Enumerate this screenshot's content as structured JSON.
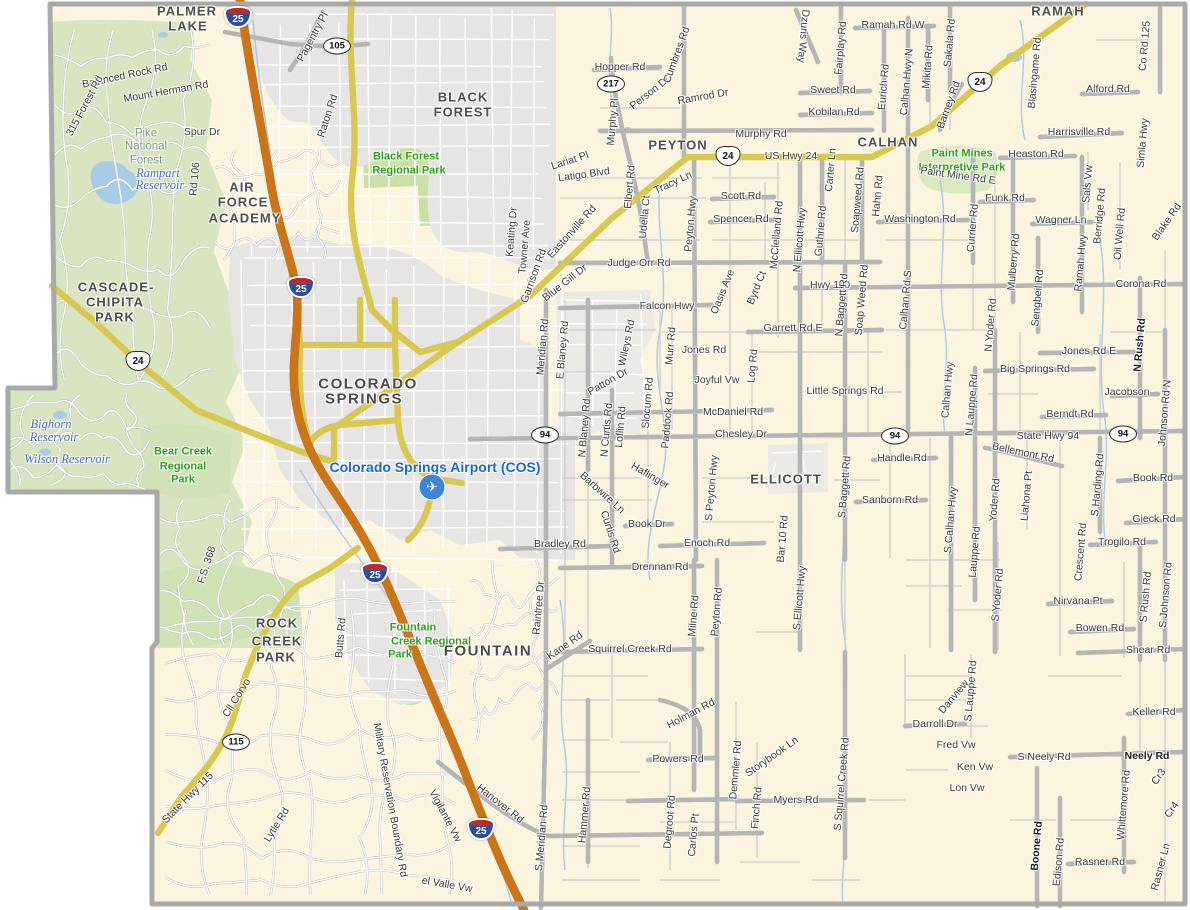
{
  "map_title": "El Paso County area road map",
  "colors": {
    "land": "#FBF4DF",
    "forest": "#D8E5C0",
    "park": "#CBE0A4",
    "urban": "#E6E5E3",
    "water": "#A6CCE8",
    "interstate": "#F19B51",
    "interstate_casing": "#C97518",
    "highway_yellow": "#FBF2A0",
    "highway_yellow_casing": "#D8C750",
    "road_white": "#FFFFFF",
    "road_casing": "#B9B9B9",
    "boundary": "#A9A9A9",
    "city_text": "#4f4f4f",
    "park_text": "#2f9e1e",
    "water_text": "#4a6fc0",
    "airport_text": "#1a66cc",
    "road_text": "#3d3d3d"
  },
  "airport": {
    "icon": "✈",
    "x": 432,
    "y": 487
  },
  "shields": [
    {
      "type": "interstate",
      "num": "25",
      "x": 238,
      "y": 17
    },
    {
      "type": "interstate",
      "num": "25",
      "x": 301,
      "y": 287
    },
    {
      "type": "interstate",
      "num": "25",
      "x": 375,
      "y": 573
    },
    {
      "type": "interstate",
      "num": "25",
      "x": 481,
      "y": 829
    },
    {
      "type": "us",
      "num": "24",
      "x": 138,
      "y": 361
    },
    {
      "type": "us",
      "num": "24",
      "x": 728,
      "y": 156
    },
    {
      "type": "us",
      "num": "24",
      "x": 980,
      "y": 82
    },
    {
      "type": "state",
      "num": "105",
      "x": 337,
      "y": 46
    },
    {
      "type": "state",
      "num": "217",
      "x": 611,
      "y": 84
    },
    {
      "type": "state",
      "num": "115",
      "x": 236,
      "y": 742
    },
    {
      "type": "state",
      "num": "94",
      "x": 545,
      "y": 435
    },
    {
      "type": "state",
      "num": "94",
      "x": 895,
      "y": 436
    },
    {
      "type": "state",
      "num": "94",
      "x": 1123,
      "y": 434
    }
  ],
  "labels": [
    {
      "t": "PALMER",
      "x": 187,
      "y": 11,
      "c": "ct"
    },
    {
      "t": "LAKE",
      "x": 188,
      "y": 26,
      "c": "ct"
    },
    {
      "t": "BLACK",
      "x": 463,
      "y": 97,
      "c": "ct"
    },
    {
      "t": "FOREST",
      "x": 463,
      "y": 112,
      "c": "ct"
    },
    {
      "t": "AIR",
      "x": 242,
      "y": 187,
      "c": "ct"
    },
    {
      "t": "FORCE",
      "x": 243,
      "y": 202,
      "c": "ct"
    },
    {
      "t": "ACADEMY",
      "x": 245,
      "y": 218,
      "c": "ct"
    },
    {
      "t": "CASCADE-",
      "x": 116,
      "y": 287,
      "c": "ct"
    },
    {
      "t": "CHIPITA",
      "x": 115,
      "y": 302,
      "c": "ct"
    },
    {
      "t": "PARK",
      "x": 115,
      "y": 317,
      "c": "ct"
    },
    {
      "t": "COLORADO",
      "x": 368,
      "y": 384,
      "c": "ctl"
    },
    {
      "t": "SPRINGS",
      "x": 364,
      "y": 399,
      "c": "ctl"
    },
    {
      "t": "PEYTON",
      "x": 678,
      "y": 145,
      "c": "ct"
    },
    {
      "t": "CALHAN",
      "x": 888,
      "y": 142,
      "c": "ct"
    },
    {
      "t": "RAMAH",
      "x": 1058,
      "y": 11,
      "c": "ct"
    },
    {
      "t": "ELLICOTT",
      "x": 786,
      "y": 479,
      "c": "ct"
    },
    {
      "t": "FOUNTAIN",
      "x": 488,
      "y": 651,
      "c": "ctl"
    },
    {
      "t": "ROCK",
      "x": 277,
      "y": 623,
      "c": "ct"
    },
    {
      "t": "CREEK",
      "x": 277,
      "y": 641,
      "c": "ct"
    },
    {
      "t": "PARK",
      "x": 276,
      "y": 657,
      "c": "ct"
    },
    {
      "t": "Pike",
      "x": 146,
      "y": 134,
      "c": "fo"
    },
    {
      "t": "National",
      "x": 146,
      "y": 147,
      "c": "fo"
    },
    {
      "t": "Forest",
      "x": 146,
      "y": 161,
      "c": "fo"
    },
    {
      "t": "Rampart",
      "x": 158,
      "y": 173,
      "c": "wt"
    },
    {
      "t": "Reservoir",
      "x": 160,
      "y": 185,
      "c": "wt"
    },
    {
      "t": "Bighorn",
      "x": 51,
      "y": 424,
      "c": "wt"
    },
    {
      "t": "Reservoir",
      "x": 54,
      "y": 437,
      "c": "wt"
    },
    {
      "t": "Wilson Reservoir",
      "x": 67,
      "y": 459,
      "c": "wt"
    },
    {
      "t": "Black Forest",
      "x": 406,
      "y": 157,
      "c": "pk"
    },
    {
      "t": "Regional Park",
      "x": 409,
      "y": 171,
      "c": "pk"
    },
    {
      "t": "Bear Creek",
      "x": 183,
      "y": 452,
      "c": "pk"
    },
    {
      "t": "Regional",
      "x": 183,
      "y": 467,
      "c": "pk"
    },
    {
      "t": "Park",
      "x": 183,
      "y": 480,
      "c": "pk"
    },
    {
      "t": "Fountain",
      "x": 413,
      "y": 628,
      "c": "pk"
    },
    {
      "t": "Creek Regional",
      "x": 431,
      "y": 642,
      "c": "pk"
    },
    {
      "t": "Park",
      "x": 400,
      "y": 655,
      "c": "pk"
    },
    {
      "t": "Paint Mines",
      "x": 962,
      "y": 154,
      "c": "pk"
    },
    {
      "t": "Interpretive Park",
      "x": 962,
      "y": 168,
      "c": "pk"
    },
    {
      "t": "Colorado Springs Airport (COS)",
      "x": 435,
      "y": 467,
      "c": "ap"
    },
    {
      "t": "Pagentry Pl",
      "x": 313,
      "y": 37,
      "r": -62
    },
    {
      "t": "Balanced Rock Rd",
      "x": 125,
      "y": 76,
      "r": -12
    },
    {
      "t": "Mount Herman Rd",
      "x": 166,
      "y": 92,
      "r": -10
    },
    {
      "t": "315 Forest Rd",
      "x": 85,
      "y": 106,
      "r": -62
    },
    {
      "t": "Spur Dr",
      "x": 202,
      "y": 132
    },
    {
      "t": "Rd 106",
      "x": 195,
      "y": 179,
      "r": -85
    },
    {
      "t": "Raton Rd",
      "x": 328,
      "y": 116,
      "r": -72
    },
    {
      "t": "Hopper Rd",
      "x": 620,
      "y": 67
    },
    {
      "t": "Murphy Pl",
      "x": 613,
      "y": 122,
      "r": -85
    },
    {
      "t": "Person Dr",
      "x": 650,
      "y": 93,
      "r": -38
    },
    {
      "t": "Cumbres Rd",
      "x": 677,
      "y": 55,
      "r": -70
    },
    {
      "t": "Ramrod Dr",
      "x": 703,
      "y": 97,
      "r": -10
    },
    {
      "t": "Murphy Rd",
      "x": 761,
      "y": 134
    },
    {
      "t": "Dzuris Way",
      "x": 803,
      "y": 36,
      "r": 95
    },
    {
      "t": "Fairplay Rd",
      "x": 841,
      "y": 48,
      "r": -85
    },
    {
      "t": "Ramah Rd W",
      "x": 893,
      "y": 25
    },
    {
      "t": "Sweet Rd",
      "x": 833,
      "y": 90
    },
    {
      "t": "Kobilan Rd",
      "x": 834,
      "y": 112
    },
    {
      "t": "Eurich Rd",
      "x": 884,
      "y": 87,
      "r": -85
    },
    {
      "t": "Calhan Hwy N",
      "x": 907,
      "y": 82,
      "r": -85
    },
    {
      "t": "Mikita Rd",
      "x": 928,
      "y": 67,
      "r": -85
    },
    {
      "t": "Sakala Rd",
      "x": 950,
      "y": 43,
      "r": -85
    },
    {
      "t": "Barney Rd",
      "x": 949,
      "y": 105,
      "r": -70
    },
    {
      "t": "Blasingame Rd",
      "x": 1035,
      "y": 73,
      "r": -85
    },
    {
      "t": "Co Rd 125",
      "x": 1145,
      "y": 46,
      "r": -85
    },
    {
      "t": "Alford Rd",
      "x": 1108,
      "y": 89
    },
    {
      "t": "Harrisville Rd",
      "x": 1079,
      "y": 132
    },
    {
      "t": "Simla Hwy",
      "x": 1143,
      "y": 143,
      "r": -85
    },
    {
      "t": "Heaston Rd",
      "x": 1036,
      "y": 154
    },
    {
      "t": "Paint Mine Rd E",
      "x": 958,
      "y": 176,
      "r": 8
    },
    {
      "t": "Funk Rd",
      "x": 1005,
      "y": 198
    },
    {
      "t": "Wagner Ln",
      "x": 1061,
      "y": 220
    },
    {
      "t": "Sals Vw",
      "x": 1088,
      "y": 184,
      "r": -85
    },
    {
      "t": "Berridge Rd",
      "x": 1100,
      "y": 216,
      "r": -85
    },
    {
      "t": "Oil Well Rd",
      "x": 1120,
      "y": 234,
      "r": -85
    },
    {
      "t": "Blake Rd",
      "x": 1167,
      "y": 222,
      "r": -55
    },
    {
      "t": "Carter Ln",
      "x": 831,
      "y": 170,
      "r": -85
    },
    {
      "t": "Soapweed Rd",
      "x": 858,
      "y": 200,
      "r": -85
    },
    {
      "t": "Hahn Rd",
      "x": 878,
      "y": 196,
      "r": -85
    },
    {
      "t": "Washington Rd",
      "x": 920,
      "y": 219
    },
    {
      "t": "Currier Rd",
      "x": 973,
      "y": 228,
      "r": -85
    },
    {
      "t": "Mulberry Rd",
      "x": 1014,
      "y": 262,
      "r": -85
    },
    {
      "t": "Sengbeil Rd",
      "x": 1038,
      "y": 298,
      "r": -85
    },
    {
      "t": "Ramah Hwy",
      "x": 1081,
      "y": 263,
      "r": -85
    },
    {
      "t": "Corona Rd",
      "x": 1141,
      "y": 284
    },
    {
      "t": "US Hwy 24",
      "x": 791,
      "y": 156
    },
    {
      "t": "Scott Rd",
      "x": 741,
      "y": 196
    },
    {
      "t": "Spencer Rd",
      "x": 741,
      "y": 219
    },
    {
      "t": "McClelland Rd",
      "x": 777,
      "y": 235,
      "r": -85
    },
    {
      "t": "Guthrie Rd",
      "x": 821,
      "y": 231,
      "r": -85
    },
    {
      "t": "N Ellicott Hwy",
      "x": 800,
      "y": 240,
      "r": -85
    },
    {
      "t": "Peyton Hwy",
      "x": 691,
      "y": 224,
      "r": -85
    },
    {
      "t": "Tracy Ln",
      "x": 673,
      "y": 183,
      "r": -25
    },
    {
      "t": "Udella Ct",
      "x": 645,
      "y": 217,
      "r": -85
    },
    {
      "t": "Elbert Rd",
      "x": 630,
      "y": 187,
      "r": -85
    },
    {
      "t": "Lariat Pl",
      "x": 570,
      "y": 161,
      "r": -18
    },
    {
      "t": "Latigo Blvd",
      "x": 584,
      "y": 175,
      "r": -8
    },
    {
      "t": "Keating Dr",
      "x": 512,
      "y": 232,
      "r": -85
    },
    {
      "t": "Towner Ave",
      "x": 525,
      "y": 247,
      "r": -85
    },
    {
      "t": "Garrison Rd",
      "x": 534,
      "y": 276,
      "r": -70
    },
    {
      "t": "Eastonville Rd",
      "x": 572,
      "y": 232,
      "r": -48
    },
    {
      "t": "Blue Gill Dr",
      "x": 565,
      "y": 283,
      "r": -38
    },
    {
      "t": "Judge Orr Rd",
      "x": 639,
      "y": 263
    },
    {
      "t": "Hwy 110",
      "x": 830,
      "y": 285
    },
    {
      "t": "Falcon Hwy",
      "x": 667,
      "y": 306
    },
    {
      "t": "Oasis Ave",
      "x": 723,
      "y": 292,
      "r": -68
    },
    {
      "t": "Byrd Ct",
      "x": 757,
      "y": 288,
      "r": -68
    },
    {
      "t": "Garrett Rd E",
      "x": 793,
      "y": 328
    },
    {
      "t": "Log Rd",
      "x": 753,
      "y": 366,
      "r": -85
    },
    {
      "t": "Jones Rd",
      "x": 704,
      "y": 350
    },
    {
      "t": "Joyful Vw",
      "x": 717,
      "y": 380
    },
    {
      "t": "Murr Rd",
      "x": 671,
      "y": 346,
      "r": -85
    },
    {
      "t": "Wileys Rd",
      "x": 627,
      "y": 343,
      "r": -78
    },
    {
      "t": "Patton Dr",
      "x": 608,
      "y": 382,
      "r": -30
    },
    {
      "t": "Slocum Rd",
      "x": 648,
      "y": 403,
      "r": -85
    },
    {
      "t": "Paddock Rd",
      "x": 668,
      "y": 420,
      "r": -85
    },
    {
      "t": "Meridian Rd",
      "x": 543,
      "y": 347,
      "r": -85
    },
    {
      "t": "E Blaney Rd",
      "x": 563,
      "y": 350,
      "r": -85
    },
    {
      "t": "N Blaney Rd",
      "x": 585,
      "y": 428,
      "r": -85
    },
    {
      "t": "N Curtis Rd",
      "x": 607,
      "y": 430,
      "r": -85
    },
    {
      "t": "Loflin Rd",
      "x": 621,
      "y": 427,
      "r": -85
    },
    {
      "t": "N Baggett Rd",
      "x": 842,
      "y": 305,
      "r": -85
    },
    {
      "t": "Soap Weed Rd",
      "x": 862,
      "y": 300,
      "r": -85
    },
    {
      "t": "Calhan Rd S",
      "x": 906,
      "y": 300,
      "r": -85
    },
    {
      "t": "Little Springs Rd",
      "x": 845,
      "y": 391
    },
    {
      "t": "Big Springs Rd",
      "x": 1035,
      "y": 369
    },
    {
      "t": "Jones Rd E",
      "x": 1089,
      "y": 351
    },
    {
      "t": "N Yoder Rd",
      "x": 991,
      "y": 325,
      "r": -85
    },
    {
      "t": "N Lauppe Rd",
      "x": 972,
      "y": 405,
      "r": -85
    },
    {
      "t": "Calhan Hwy",
      "x": 948,
      "y": 390,
      "r": -85
    },
    {
      "t": "Jacobson",
      "x": 1127,
      "y": 392
    },
    {
      "t": "Berndt Rd",
      "x": 1070,
      "y": 414
    },
    {
      "t": "N Rush Rd",
      "x": 1140,
      "y": 345,
      "r": -85,
      "c": "rdb"
    },
    {
      "t": "Johnson Rd N",
      "x": 1165,
      "y": 413,
      "r": -85
    },
    {
      "t": "State Hwy 94",
      "x": 1048,
      "y": 436
    },
    {
      "t": "McDaniel Rd",
      "x": 733,
      "y": 412
    },
    {
      "t": "Chesley Dr",
      "x": 741,
      "y": 434
    },
    {
      "t": "Handle Rd",
      "x": 902,
      "y": 458
    },
    {
      "t": "Bellemont Rd",
      "x": 1023,
      "y": 453,
      "r": 12
    },
    {
      "t": "Sanborn Rd",
      "x": 890,
      "y": 500
    },
    {
      "t": "Book Rd",
      "x": 1153,
      "y": 478
    },
    {
      "t": "Gieck Rd",
      "x": 1154,
      "y": 519
    },
    {
      "t": "Trogilo Rd",
      "x": 1122,
      "y": 542
    },
    {
      "t": "Liahona Pt",
      "x": 1027,
      "y": 496,
      "r": -85
    },
    {
      "t": "S Harding Rd",
      "x": 1098,
      "y": 485,
      "r": -85
    },
    {
      "t": "Crescent Rd",
      "x": 1081,
      "y": 552,
      "r": -85
    },
    {
      "t": "Yoder Rd",
      "x": 995,
      "y": 500,
      "r": -85
    },
    {
      "t": "S Yoder Rd",
      "x": 998,
      "y": 595,
      "r": -85
    },
    {
      "t": "Lauppe Rd",
      "x": 975,
      "y": 552,
      "r": -85
    },
    {
      "t": "S Calhan Hwy",
      "x": 951,
      "y": 520,
      "r": -85
    },
    {
      "t": "S Baggett Rd",
      "x": 845,
      "y": 487,
      "r": -85
    },
    {
      "t": "Bar 10 Rd",
      "x": 783,
      "y": 539,
      "r": -85
    },
    {
      "t": "S Ellicott Hwy",
      "x": 800,
      "y": 598,
      "r": -85
    },
    {
      "t": "S Peyton Hwy",
      "x": 712,
      "y": 488,
      "r": -85
    },
    {
      "t": "Haflinger",
      "x": 650,
      "y": 476,
      "r": 30
    },
    {
      "t": "Barbwire Ln",
      "x": 602,
      "y": 493,
      "r": 42
    },
    {
      "t": "Curtis Rd",
      "x": 610,
      "y": 532,
      "r": 72
    },
    {
      "t": "Book Dr",
      "x": 647,
      "y": 524
    },
    {
      "t": "Bradley Rd",
      "x": 560,
      "y": 544
    },
    {
      "t": "Enoch Rd",
      "x": 707,
      "y": 543
    },
    {
      "t": "Drennan Rd",
      "x": 660,
      "y": 567
    },
    {
      "t": "Nirvana Pt",
      "x": 1078,
      "y": 601
    },
    {
      "t": "Bowen Rd",
      "x": 1100,
      "y": 628
    },
    {
      "t": "S Rush Rd",
      "x": 1146,
      "y": 597,
      "r": -85
    },
    {
      "t": "S Johnson Rd",
      "x": 1166,
      "y": 595,
      "r": -85
    },
    {
      "t": "Shear Rd",
      "x": 1148,
      "y": 650
    },
    {
      "t": "Keller Rd",
      "x": 1154,
      "y": 712
    },
    {
      "t": "Raintree Dr",
      "x": 539,
      "y": 608,
      "r": -85
    },
    {
      "t": "Kane Rd",
      "x": 565,
      "y": 646,
      "r": -35
    },
    {
      "t": "Squirrel Creek Rd",
      "x": 630,
      "y": 649
    },
    {
      "t": "Milne Rd",
      "x": 694,
      "y": 616,
      "r": -85
    },
    {
      "t": "Peyton Rd",
      "x": 717,
      "y": 612,
      "r": -85
    },
    {
      "t": "Butts Rd",
      "x": 341,
      "y": 638,
      "r": -85
    },
    {
      "t": "Cll Corvo",
      "x": 237,
      "y": 698,
      "r": -58
    },
    {
      "t": "State Hwy 115",
      "x": 188,
      "y": 798,
      "r": -45
    },
    {
      "t": "Lytle Rd",
      "x": 277,
      "y": 825,
      "r": -58
    },
    {
      "t": "F.S. 368",
      "x": 207,
      "y": 565,
      "r": -72
    },
    {
      "t": "Military Reservation Boundary Rd",
      "x": 390,
      "y": 800,
      "r": 80
    },
    {
      "t": "Vigilante Vw",
      "x": 445,
      "y": 816,
      "r": 62
    },
    {
      "t": "el Valle Vw",
      "x": 447,
      "y": 885,
      "r": 10
    },
    {
      "t": "Hanover Rd",
      "x": 500,
      "y": 804,
      "r": 38
    },
    {
      "t": "S Meridian Rd",
      "x": 542,
      "y": 838,
      "r": -85
    },
    {
      "t": "Hammer Rd",
      "x": 585,
      "y": 815,
      "r": -85
    },
    {
      "t": "Holman Rd",
      "x": 691,
      "y": 714,
      "r": -28
    },
    {
      "t": "Powers Rd",
      "x": 678,
      "y": 759
    },
    {
      "t": "Degroot Rd",
      "x": 670,
      "y": 822,
      "r": -85
    },
    {
      "t": "Carlos Pt",
      "x": 694,
      "y": 835,
      "r": -85
    },
    {
      "t": "Demmler Rd",
      "x": 736,
      "y": 770,
      "r": -85
    },
    {
      "t": "Storybook Ln",
      "x": 772,
      "y": 757,
      "r": -35
    },
    {
      "t": "Finch Rd",
      "x": 757,
      "y": 808,
      "r": -85
    },
    {
      "t": "Myers Rd",
      "x": 796,
      "y": 800
    },
    {
      "t": "S Squirrel Creek Rd",
      "x": 842,
      "y": 784,
      "r": -85
    },
    {
      "t": "Danview",
      "x": 954,
      "y": 697,
      "r": -50
    },
    {
      "t": "S Lauppe Rd",
      "x": 971,
      "y": 691,
      "r": -85
    },
    {
      "t": "Darroll Dr",
      "x": 935,
      "y": 724
    },
    {
      "t": "Fred Vw",
      "x": 956,
      "y": 745
    },
    {
      "t": "Ken Vw",
      "x": 975,
      "y": 767
    },
    {
      "t": "Lon Vw",
      "x": 967,
      "y": 788
    },
    {
      "t": "S Neely Rd",
      "x": 1044,
      "y": 757
    },
    {
      "t": "Neely Rd",
      "x": 1147,
      "y": 756,
      "c": "rdb"
    },
    {
      "t": "Boone Rd",
      "x": 1037,
      "y": 846,
      "r": -85,
      "c": "rdb"
    },
    {
      "t": "Edison Rd",
      "x": 1059,
      "y": 862,
      "r": -85
    },
    {
      "t": "Whittemore Rd",
      "x": 1124,
      "y": 805,
      "r": -85
    },
    {
      "t": "Rasner Rd",
      "x": 1100,
      "y": 862
    },
    {
      "t": "Rasner Ln",
      "x": 1161,
      "y": 867,
      "r": -75
    },
    {
      "t": "Cr3",
      "x": 1159,
      "y": 777,
      "r": -55
    },
    {
      "t": "Cr4",
      "x": 1172,
      "y": 810,
      "r": -55
    }
  ]
}
